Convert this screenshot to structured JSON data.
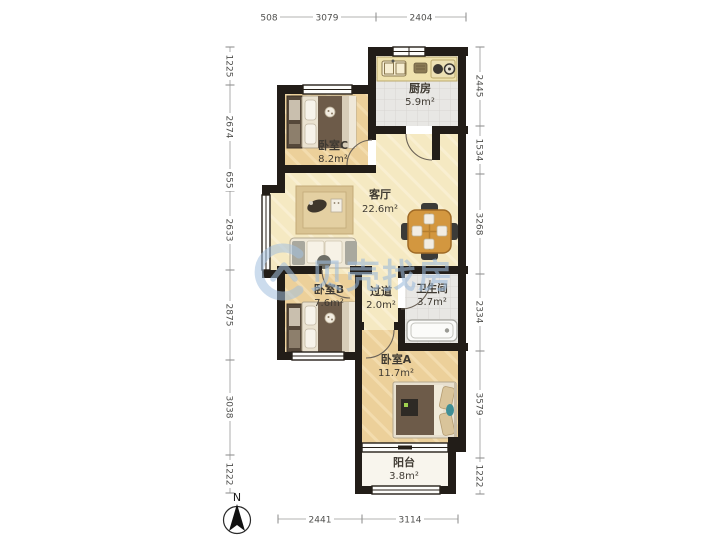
{
  "watermark": {
    "text": "贝壳找房"
  },
  "compass": {
    "label": "N"
  },
  "rooms": [
    {
      "name": "卧室C",
      "area": "8.2m²"
    },
    {
      "name": "厨房",
      "area": "5.9m²"
    },
    {
      "name": "客厅",
      "area": "22.6m²"
    },
    {
      "name": "卧室B",
      "area": "7.6m²"
    },
    {
      "name": "过道",
      "area": "2.0m²"
    },
    {
      "name": "卫生间",
      "area": "3.7m²"
    },
    {
      "name": "卧室A",
      "area": "11.7m²"
    },
    {
      "name": "阳台",
      "area": "3.8m²"
    }
  ],
  "dimensions": {
    "top": [
      "508",
      "3079",
      "2404"
    ],
    "bottom": [
      "2441",
      "3114"
    ],
    "left": [
      "1225",
      "2674",
      "655",
      "2633",
      "2875",
      "3038",
      "1222"
    ],
    "right": [
      "2445",
      "1534",
      "3268",
      "2334",
      "3579",
      "1222"
    ]
  },
  "colors": {
    "wall": "#221d18",
    "bedroom_floor": "#ecd09a",
    "living_floor": "#f5e9c2",
    "tile_floor": "#e8e7e4",
    "balcony_floor": "#f8f5ed",
    "watermark": "#9dbcdd",
    "blanket": "#6d5b49",
    "dining_table": "#d3973f"
  }
}
